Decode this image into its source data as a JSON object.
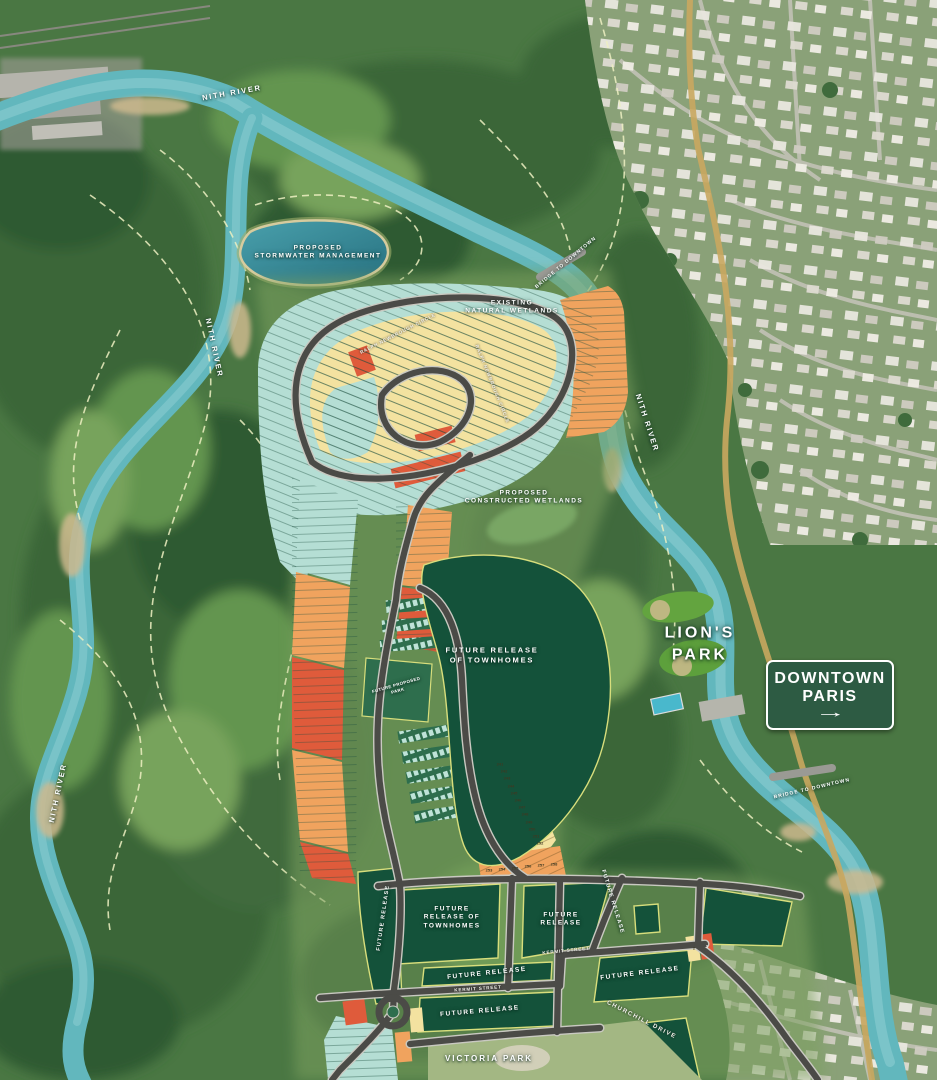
{
  "palette": {
    "lot_teal": "#b5ded4",
    "lot_yellow": "#f3e2a0",
    "lot_orange": "#f0a35e",
    "lot_red": "#df5b3b",
    "parcel_dark_green": "#14523a",
    "parcel_outline": "#d8de7c",
    "road_dark": "#4b4b47",
    "river_blue": "#62b7bd",
    "sign_green": "#2d5b43",
    "forest_green": "#4a7743"
  },
  "labels": {
    "nith_river": "NITH RIVER",
    "bridge_to_downtown": "BRIDGE TO DOWNTOWN",
    "stormwater_line1": "PROPOSED",
    "stormwater_line2": "STORMWATER MANAGEMENT",
    "wetlands_line1": "EXISTING",
    "wetlands_line2": "NATURAL WETLANDS",
    "constructed_line1": "PROPOSED",
    "constructed_line2": "CONSTRUCTED WETLANDS",
    "townhomes_mid_line1": "FUTURE RELEASE",
    "townhomes_mid_line2": "OF TOWNHOMES",
    "future_release": "FUTURE RELEASE",
    "future_line1": "FUTURE",
    "future_line2": "RELEASE",
    "townhomes_bottom_line1": "FUTURE",
    "townhomes_bottom_line2": "RELEASE OF",
    "townhomes_bottom_line3": "TOWNHOMES",
    "proposed_park_line1": "FUTURE PROPOSED",
    "proposed_park_line2": "PARK",
    "lions_line1": "LION'S",
    "lions_line2": "PARK",
    "victoria_park": "VICTORIA PARK"
  },
  "sign": {
    "line1": "DOWNTOWN",
    "line2": "PARIS",
    "arrow": "→"
  },
  "streets": {
    "ralph": "RALPH NEWBROUGH CIRCLE",
    "kermit": "KERMIT STREET",
    "churchill": "CHURCHILL DRIVE"
  },
  "lots": {
    "yellow_row": [
      "241",
      "242",
      "243",
      "244",
      "245",
      "246",
      "247",
      "248",
      "249",
      "250",
      "251",
      "252"
    ],
    "orange_row": [
      "253",
      "254",
      "255",
      "256",
      "257",
      "258"
    ],
    "corner": [
      "2",
      "1"
    ]
  }
}
